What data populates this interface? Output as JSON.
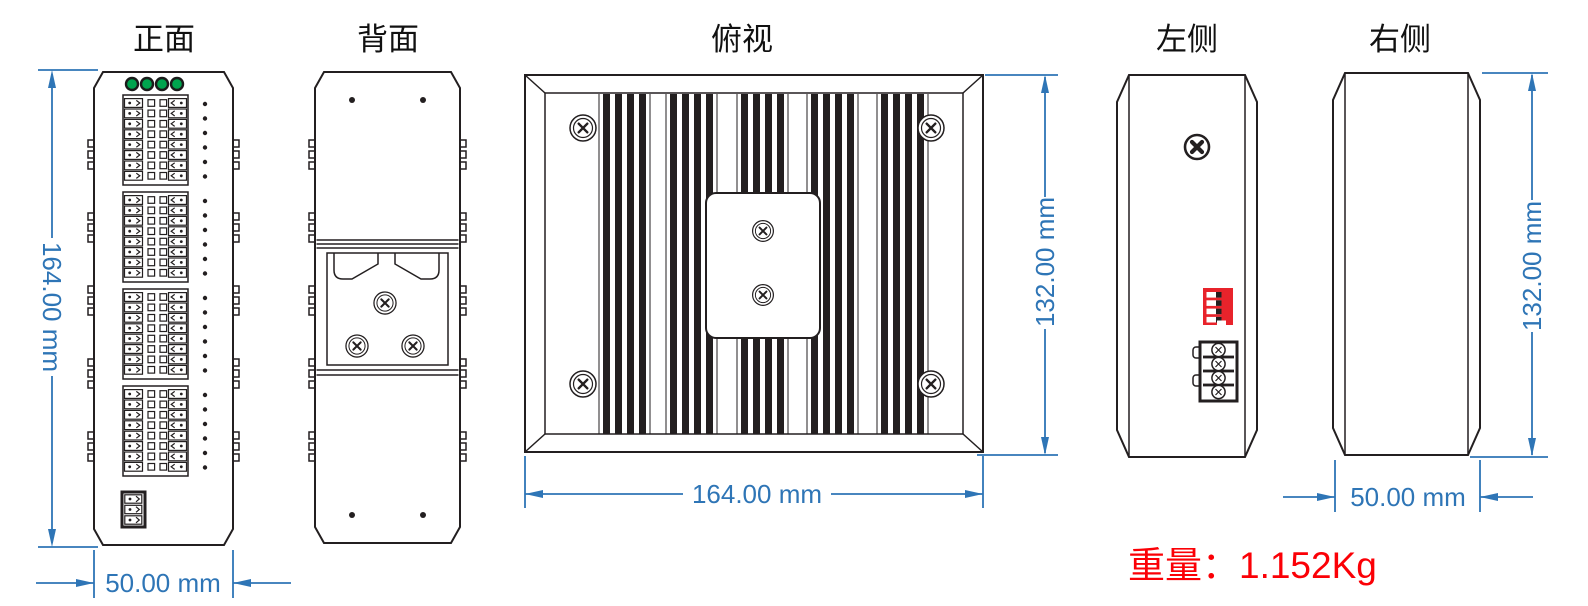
{
  "page": {
    "background": "#ffffff"
  },
  "drawing": {
    "views": {
      "front": {
        "title": "正面",
        "height_label": "164.00 mm",
        "width_label": "50.00 mm"
      },
      "back": {
        "title": "背面"
      },
      "top": {
        "title": "俯视",
        "width_label": "164.00 mm",
        "depth_label": "132.00 mm"
      },
      "left": {
        "title": "左侧"
      },
      "right": {
        "title": "右侧",
        "depth_label": "132.00 mm",
        "width_label": "50.00 mm"
      }
    },
    "weight_label": "重量：1.152Kg",
    "colors": {
      "dimension_blue": "#2e75b6",
      "line_dark": "#231f20",
      "weight_red": "#fb0006",
      "led_green": "#00a44e",
      "dip_switch_red": "#e8232b"
    }
  }
}
